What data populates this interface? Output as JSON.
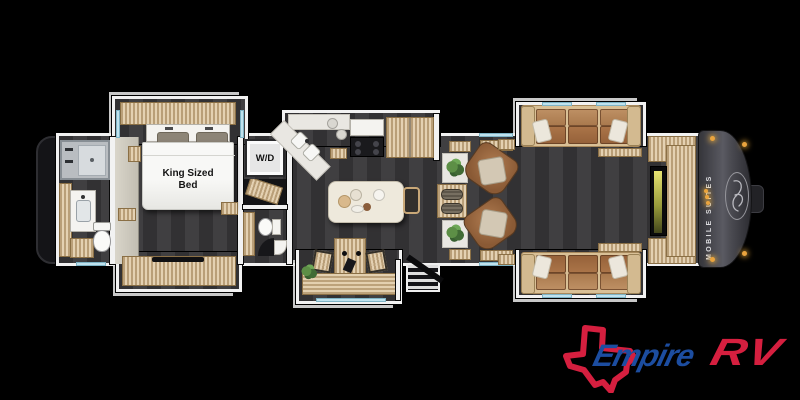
{
  "floorplan": {
    "bed_label": "King Sized Bed",
    "washer_dryer_label": "W/D",
    "cap_brand": "MOBILE SUITES"
  },
  "logo": {
    "brand_part1": "Empire",
    "brand_part2": "RV"
  },
  "icons": {
    "texas_outline": "texas-state-outline-icon",
    "cap_emblem": "script-monogram-icon"
  },
  "colors": {
    "background": "#000000",
    "floor": "#3a393b",
    "wall": "#f2f2f2",
    "wood": "#dcc49c",
    "window": "#bfe2ee",
    "cap": "#47474d",
    "marker_light": "#eaa43e",
    "leather": "#a06b44",
    "leather_dark": "#6f4c34",
    "tv_glow": "#d6d84f",
    "logo_blue": "#1c4da0",
    "logo_red": "#d51f3f"
  }
}
